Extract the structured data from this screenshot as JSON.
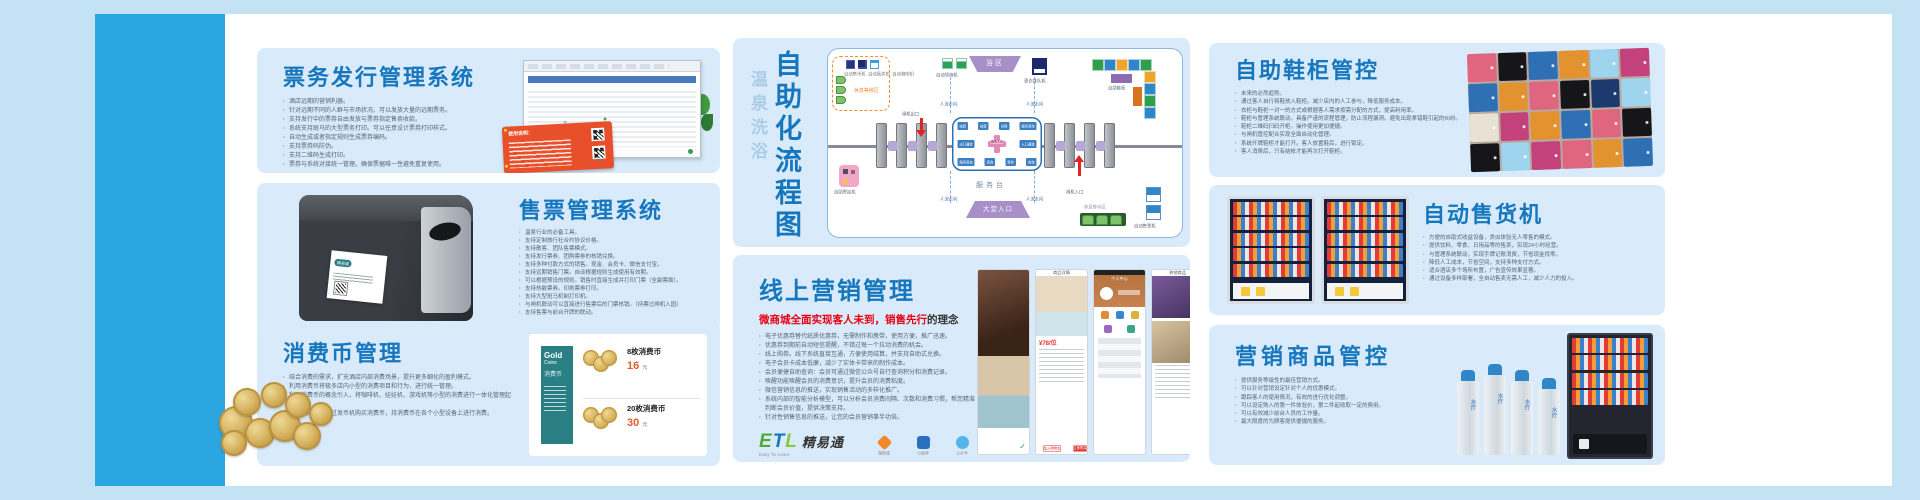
{
  "sections": {
    "ticket": {
      "title": "票务发行管理系统",
      "redcard_title": "使用说明：",
      "bullets": [
        "酒店远期的营销利器。",
        "针对远期不同的人群与市场状况。可以发放大量的远期票务。",
        "支持发行中的票券自由发放与票券指定售卖收款。",
        "系统支持斑马的大型票务打印。可以任意设计票券打印样式。",
        "自动生成或者指定规则生成票券编码。",
        "支持票券码防伪。",
        "支持二维码生成打印。",
        "票券与系统对接统一管理。确保票据唯一性避免重复使用。"
      ]
    },
    "sale": {
      "title": "售票管理系统",
      "printer_label": "精易通",
      "bullets": [
        "温泉行业的必备工具。",
        "支持定制旅行社合约协议价格。",
        "支持散客、团队售票模式。",
        "支持发行票券、团购票券的核销兑换。",
        "支持多种付款方式的销售。现金、会员卡、微信支付宝。",
        "支持远期销售门票。自动根据规则生成使用有效期。",
        "可以根据预设的规则。销售时直接生成并打印门票（全副票面）。",
        "支持热敏票券。印刷票券打印。",
        "支持大型斑马机制打印机。",
        "与闸机联动可以直接进行售票后的门票核销。（持票过闸机入园）",
        "支持售票与前台开牌的联动。"
      ]
    },
    "coin": {
      "title": "消费币管理",
      "bullets": [
        "结合消费的需求，扩充酒店内部消费场景，提升更多细化的盈利模式。",
        "利用消费币将极多店内小型的消费项目和行为，进行统一管理。",
        "利用消费币的概念引入，将咖啡机、娃娃机、游戏机等小型的消费进行一体化管理起来。",
        "客人利用手牌通过发币机购买消费币，持消费币在各个小型设备上进行消费。"
      ],
      "gold": {
        "l1": "Gold",
        "l2": "Coins",
        "l3": "消费币"
      },
      "prices": [
        {
          "label": "8枚消费币",
          "num": "16",
          "unit": "元"
        },
        {
          "label": "20枚消费币",
          "num": "30",
          "unit": "元"
        }
      ]
    },
    "flow": {
      "title_sub": "温泉洗浴",
      "title_main": "自助化流程图",
      "labels": {
        "rest_top": "休息等候区",
        "machines": [
          "自动售币机",
          "自动贩卖机",
          "自动咖啡机"
        ],
        "robe": "自动领袍机",
        "bath": "浴区",
        "queue": "更衣排队机",
        "locker": "自助鞋柜",
        "exit": "闸机出口",
        "entry": "闸机入口",
        "flow": "人流走向",
        "hang": "自助寄挂机",
        "desk": "服务台",
        "hall": "大堂入口",
        "rest_bottom": "休息等待区",
        "tvm": "自动售票机"
      },
      "island": {
        "center": "服务人员",
        "cells": [
          "结算",
          "结算",
          "兑换",
          "服务咨询",
          "出口通道",
          "入口通道",
          "服务咨询",
          "咨询",
          "寄存",
          "查询"
        ]
      }
    },
    "marketing": {
      "title": "线上营销管理",
      "subtitle_red": "微商城全面实现客人未到，销售先行",
      "subtitle_dark": "的理念",
      "bullets": [
        "电子优惠券替代纸质优惠券，无需制作和携带，使用方便，推广迅速。",
        "优惠券到期前自动短信提醒，不错过每一个拉动消费的机会。",
        "线上购券。线下系统直接互通，方便使用结算，并支持自助式兑换。",
        "电子会员卡成本低廉，减少了实体卡带来的制作成本。",
        "会员便捷自助查询：会员可通过微信公众号自行查询积分和消费记录。",
        "唤醒功能唤醒会员的消费意识，提升会员的消费粘度。",
        "微信营销信息的推送，实现销售活动的多样化推广。",
        "系统内部的智能分析模型，可以分析会员消费间隔、次数和消费习惯，帮您精准判断会员价值，提供决策支持。",
        "针对性销售信息的推送，让您的会员营销事半功倍。"
      ],
      "logo": {
        "etl_e": "E",
        "etl_t": "T",
        "etl_l": "L",
        "cn": "精易通",
        "tagline": "Easy To Learn"
      },
      "apps": [
        {
          "label": "微商城"
        },
        {
          "label": "小程序"
        },
        {
          "label": "公众号"
        }
      ],
      "phone": {
        "detail": "商品详情",
        "price": "¥78/位",
        "cart": "加入购物车",
        "buy": "立即购买",
        "profile": "个人中心",
        "hot": "热销商品",
        "check": "✓"
      }
    },
    "shoe": {
      "title": "自助鞋柜管控",
      "bullets": [
        "未来的必然趋势。",
        "通过客人自行将鞋放入鞋柜。减少店内的人工参与，降低服务成本。",
        "衣柜与鞋柜一对一的方式或根据客人需求按需分配的方式，提高利用率。",
        "鞋柜与管理系统联动。具备严谨的流程管理，防止流程漏洞。避免出现拿错鞋引起的纠纷。",
        "鞋柜二维码扫码开柜。操作使用更加便捷。",
        "与闸机管控配合实现全面自动化管理。",
        "系统开牌鞋柜才能打开。客人放置鞋后，进行锁定。",
        "客人消费后，只有结帐才能再次打开鞋柜。"
      ]
    },
    "vending": {
      "title": "自动售货机",
      "bullets": [
        "方便的自助式收益设备，类似体验无人零售的模式。",
        "提供饮料、零食、日用品等的售卖，实现24小时经营。",
        "与管理系统联动，实现手牌记账消费，节省现金找零。",
        "降低人工成本，节省空间，支持多种支付方式。",
        "适合酒店多个场所布置，广告宣传效果显著。",
        "通过设备多样部署，全自动售卖无需人工，减少人力的投入。"
      ]
    },
    "goods": {
      "title": "营销商品管控",
      "bottle_label": "水疗",
      "bullets": [
        "提供服务等级性的最佳营销方式。",
        "可以针对营销设定针对个人的优惠模式。",
        "跟踪客人的使用情况，有效的进行优化调整。",
        "可以设定购入的第一件体验价，第二件起收取一定的费用。",
        "可以有效减少前台人员的工作量。",
        "最大限度的为顾客提供便捷的服务。"
      ]
    }
  }
}
